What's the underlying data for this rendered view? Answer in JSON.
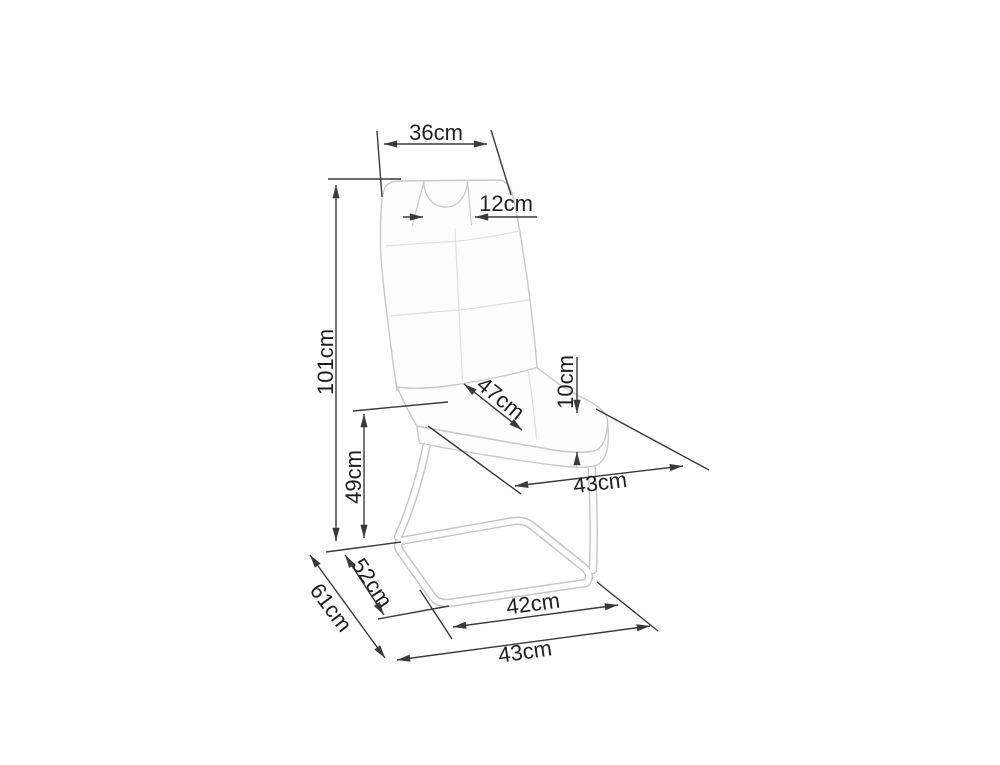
{
  "diagram": {
    "unit": "cm",
    "colors": {
      "background": "#ffffff",
      "dimension_line": "#3a3a3a",
      "label_text": "#1f1f1f",
      "chair_outline": "#c9c9c9",
      "chair_seam": "#dfdfdf"
    },
    "dimensions": {
      "top_width": "36cm",
      "handle_width": "12cm",
      "total_height": "101cm",
      "seat_height": "49cm",
      "seat_depth": "47cm",
      "cushion_thickness": "10cm",
      "seat_width": "43cm",
      "base_side_depth": "52cm",
      "total_depth": "61cm",
      "base_inner_width": "42cm",
      "base_width": "43cm"
    }
  }
}
